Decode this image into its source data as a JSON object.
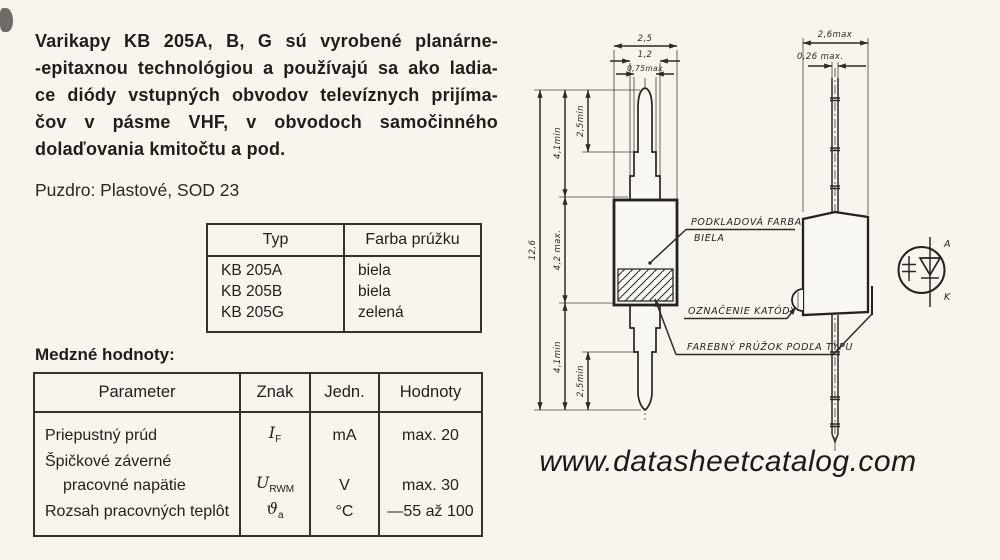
{
  "intro": {
    "lines": [
      "Varikapy KB 205A, B, G sú vyrobené planárne-",
      "-epitaxnou technológiou a používajú sa ako ladia-",
      "ce diódy vstupných obvodov televíznych prijíma-",
      "čov v pásme VHF, v obvodoch samočinného",
      "dolaďovania kmitočtu a pod."
    ]
  },
  "package": {
    "text": "Puzdro: Plastové, SOD 23"
  },
  "type_table": {
    "headers": [
      "Typ",
      "Farba prúžku"
    ],
    "rows": [
      [
        "KB 205A",
        "biela"
      ],
      [
        "KB 205B",
        "biela"
      ],
      [
        "KB 205G",
        "zelená"
      ]
    ]
  },
  "limits": {
    "heading": "Medzné hodnoty:",
    "headers": [
      "Parameter",
      "Znak",
      "Jedn.",
      "Hodnoty"
    ],
    "rows": [
      {
        "param": "Priepustný prúd",
        "sym": "I",
        "sub": "F",
        "unit": "mA",
        "value": "max. 20"
      },
      {
        "param": "Špičkové záverné",
        "param2": "pracovné napätie",
        "sym": "U",
        "sub": "RWM",
        "unit": "V",
        "value": "max. 30"
      },
      {
        "param": "Rozsah pracovných teplôt",
        "sym": "ϑ",
        "sub": "a",
        "unit": "°C",
        "value": "—55 až 100"
      }
    ]
  },
  "drawing": {
    "dim_2_5": "2,5",
    "dim_1_2": "1,2",
    "dim_075": "0,75max",
    "dim_126": "12,6",
    "dim_41_top": "4,1min",
    "dim_42": "4,2 max.",
    "dim_41_bot": "4,1min",
    "dim_25min_top": "2,5min",
    "dim_25min_bot": "2,5min",
    "dim_26": "2,6max",
    "dim_026": "0,26 max.",
    "label_base_color_1": "PODKLADOVÁ FARBA",
    "label_base_color_2": "BIELA",
    "label_cathode": "OZNAČENIE KATÓDY",
    "label_stripe": "FAREBNÝ PRÚŽOK PODĽA TYPU",
    "anode": "A",
    "cathode": "K"
  },
  "footer": {
    "url": "www.datasheetcatalog.com"
  }
}
